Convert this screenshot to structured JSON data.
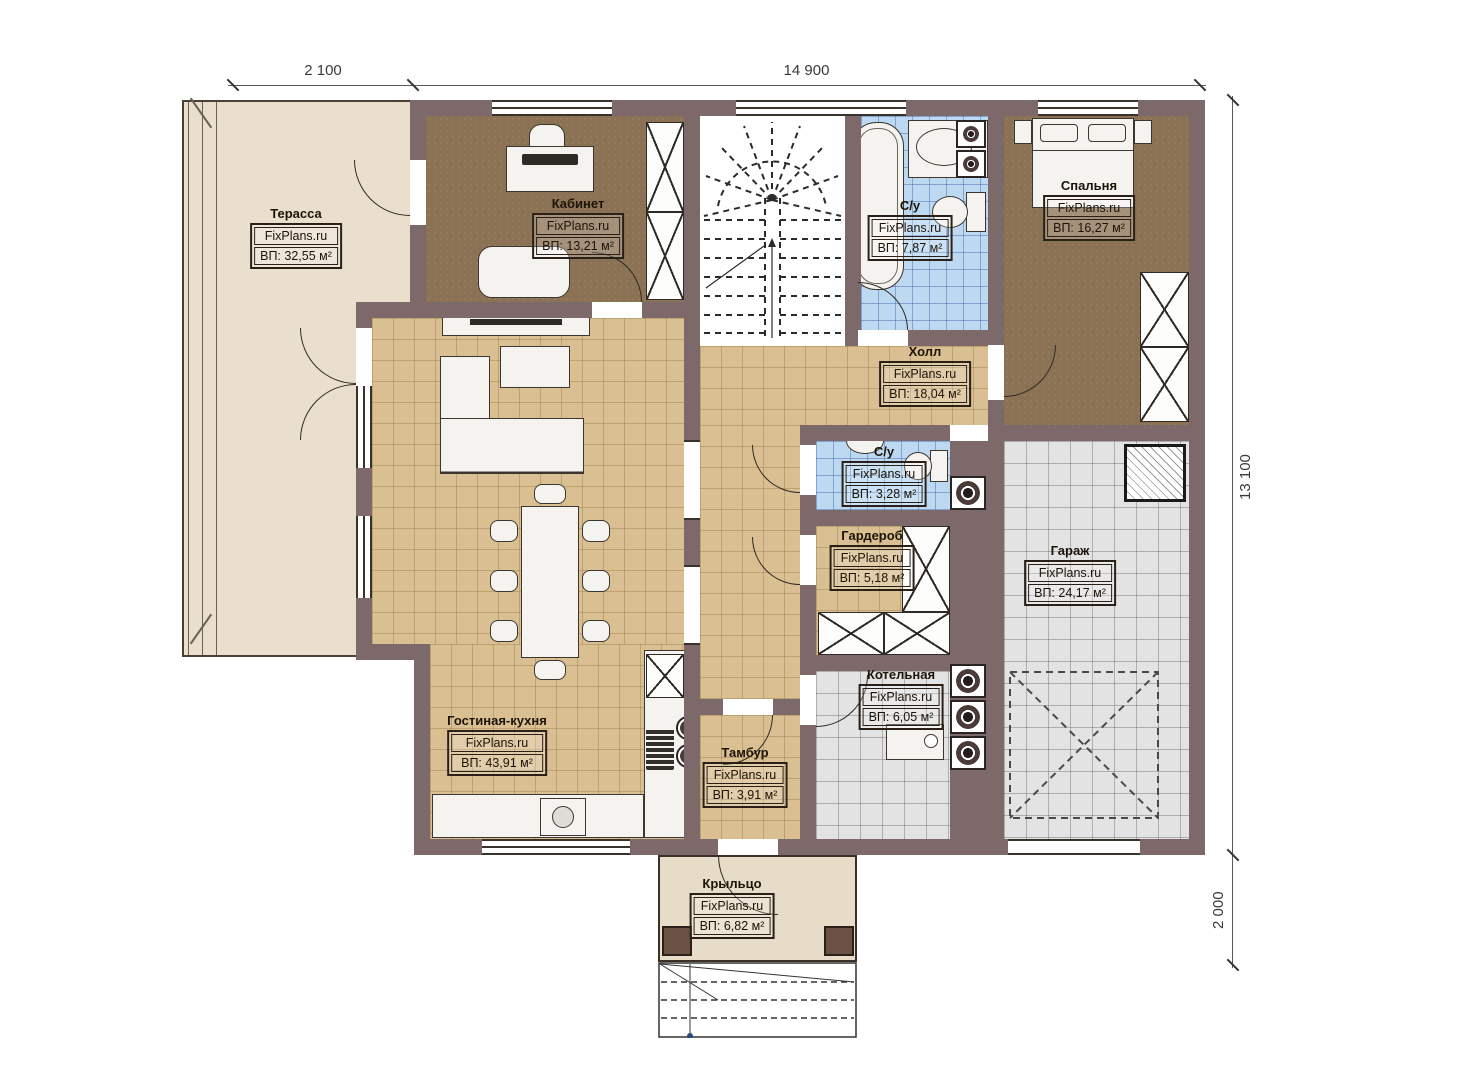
{
  "brand": {
    "site": "FixPlans.ru"
  },
  "dimensions": {
    "top_left": "2 100",
    "top_main": "14 900",
    "right_main": "13 100",
    "right_lower": "2 000"
  },
  "rooms": [
    {
      "id": "terrace",
      "name": "Терасса",
      "area": "ВП: 32,55 м²"
    },
    {
      "id": "office",
      "name": "Кабинет",
      "area": "ВП: 13,21 м²"
    },
    {
      "id": "bathroom-top",
      "name": "С/у",
      "area": "ВП: 7,87 м²"
    },
    {
      "id": "bedroom",
      "name": "Спальня",
      "area": "ВП: 16,27 м²"
    },
    {
      "id": "hall",
      "name": "Холл",
      "area": "ВП: 18,04 м²"
    },
    {
      "id": "bathroom-small",
      "name": "С/у",
      "area": "ВП: 3,28 м²"
    },
    {
      "id": "wardrobe",
      "name": "Гардероб",
      "area": "ВП: 5,18 м²"
    },
    {
      "id": "garage",
      "name": "Гараж",
      "area": "ВП: 24,17 м²"
    },
    {
      "id": "boiler-room",
      "name": "Котельная",
      "area": "ВП: 6,05 м²"
    },
    {
      "id": "vestibule",
      "name": "Тамбур",
      "area": "ВП: 3,91 м²"
    },
    {
      "id": "living-kitchen",
      "name": "Гостиная-кухня",
      "area": "ВП: 43,91 м²"
    },
    {
      "id": "porch",
      "name": "Крыльцо",
      "area": "ВП: 6,82 м²"
    }
  ],
  "colors": {
    "wall": "#7d686a",
    "tile_tan": "#d9bf92",
    "tile_blue": "#bdd9f2",
    "tile_gray": "#e3e3e3",
    "floor_brown": "#8c7254",
    "terrace_beige": "#eadfcd"
  }
}
